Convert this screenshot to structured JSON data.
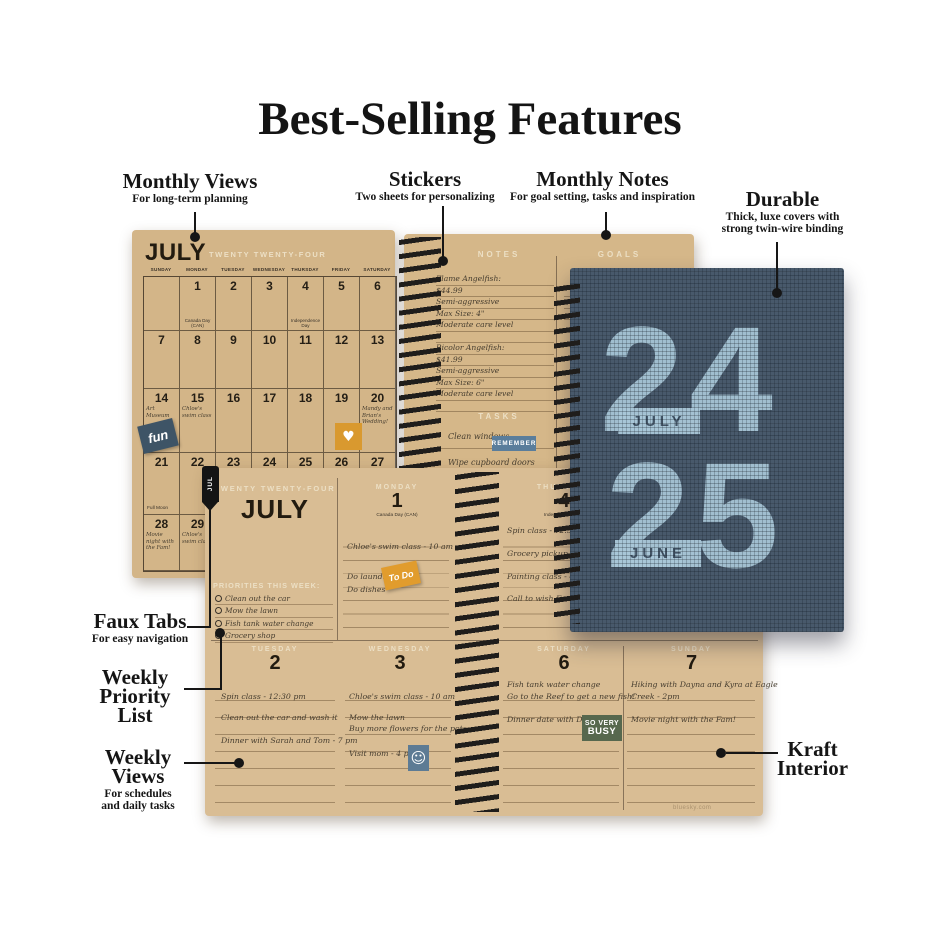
{
  "title": "Best-Selling Features",
  "callouts": {
    "monthly_views": {
      "label": "Monthly Views",
      "sub": "For long-term planning"
    },
    "stickers": {
      "label": "Stickers",
      "sub": "Two sheets for personalizing"
    },
    "monthly_notes": {
      "label": "Monthly Notes",
      "sub": "For goal setting, tasks and inspiration"
    },
    "durable": {
      "label": "Durable",
      "sub1": "Thick, luxe covers with",
      "sub2": "strong twin-wire binding"
    },
    "faux_tabs": {
      "label": "Faux Tabs",
      "sub": "For easy navigation"
    },
    "weekly_priority": {
      "line1": "Weekly",
      "line2": "Priority",
      "line3": "List"
    },
    "weekly_views": {
      "line1": "Weekly",
      "line2": "Views",
      "sub1": "For schedules",
      "sub2": "and daily tasks"
    },
    "kraft_interior": {
      "line1": "Kraft",
      "line2": "Interior"
    }
  },
  "monthly": {
    "month": "JULY",
    "year_words": "TWENTY TWENTY-FOUR",
    "day_headers": [
      "SUNDAY",
      "MONDAY",
      "TUESDAY",
      "WEDNESDAY",
      "THURSDAY",
      "FRIDAY",
      "SATURDAY"
    ],
    "weeks": [
      [
        "",
        "1",
        "2",
        "3",
        "4",
        "5",
        "6"
      ],
      [
        "7",
        "8",
        "9",
        "10",
        "11",
        "12",
        "13"
      ],
      [
        "14",
        "15",
        "16",
        "17",
        "18",
        "19",
        "20"
      ],
      [
        "21",
        "22",
        "23",
        "24",
        "25",
        "26",
        "27"
      ],
      [
        "28",
        "29",
        "30",
        "31",
        "",
        "",
        ""
      ]
    ],
    "notes": {
      "canada_day": "Canada Day (CAN)",
      "independence_day": "Independence Day",
      "art_museum": "Art Museum",
      "chloes_swim": "Chloe's swim class",
      "wedding": "Mandy and Brian's Wedding!",
      "full_moon": "Full Moon",
      "movie_night": "Movie night with the Fam!",
      "chloes_swim2": "Chloe's swim class"
    },
    "stickers": {
      "fun": "fun",
      "heart": "♥"
    }
  },
  "notes_page": {
    "notes_header": "NOTES",
    "goals_header": "GOALS",
    "tasks_header": "TASKS",
    "lines": [
      "Flame Angelfish:",
      "$44.99",
      "Semi-aggressive",
      "Max Size: 4\"",
      "Moderate care level",
      "",
      "Bicolor Angelfish:",
      "$41.99",
      "Semi-aggressive",
      "Max Size: 6\"",
      "Moderate care level",
      ""
    ],
    "tasks": [
      "Clean windows",
      "Wipe cupboard doors"
    ],
    "remember_sticker": "REMEMBER"
  },
  "weekly": {
    "tab": "JUL",
    "year_words": "TWENTY TWENTY-FOUR",
    "month": "JULY",
    "priorities_label": "PRIORITIES THIS WEEK:",
    "priorities": [
      "Clean out the car",
      "Mow the lawn",
      "Fish tank water change",
      "Grocery shop"
    ],
    "monday": {
      "name": "MONDAY",
      "num": "1",
      "holiday": "Canada Day (CAN)",
      "entries": [
        "Chloe's swim class - 10 am",
        "Do laundry",
        "Do dishes"
      ]
    },
    "thursday": {
      "name": "THURSDAY",
      "num": "4",
      "holiday": "Independence Day",
      "entries": [
        "Spin class - 12:30 pm",
        "Grocery pickup",
        "Painting class - 4 pm",
        "Call to wish Em"
      ]
    },
    "tuesday": {
      "name": "TUESDAY",
      "num": "2",
      "entries": [
        "Spin class - 12:30 pm",
        "Clean out the car and wash it",
        "Dinner with Sarah and Tom - 7 pm"
      ]
    },
    "wednesday": {
      "name": "WEDNESDAY",
      "num": "3",
      "entries": [
        "Chloe's swim class - 10 am",
        "Mow the lawn",
        "Buy more flowers for the pots",
        "Visit mom - 4 pm"
      ]
    },
    "saturday": {
      "name": "SATURDAY",
      "num": "6",
      "entries": [
        "Fish tank water change",
        "Go to the Reef to get a new fish!",
        "Dinner date with Dan"
      ]
    },
    "sunday": {
      "name": "SUNDAY",
      "num": "7",
      "entries": [
        "Hiking with Dayna and Kyra at Eagle",
        "Creek - 2pm",
        "Movie night with the Fam!"
      ]
    },
    "stickers": {
      "to_do": "To Do",
      "smiley": "☺",
      "busy_line1": "SO VERY",
      "busy_line2": "BUSY"
    },
    "footer": "bluesky.com"
  },
  "cover": {
    "top_num": "24",
    "top_month": "JULY",
    "bottom_num": "25",
    "bottom_month": "JUNE"
  },
  "colors": {
    "kraft": "#d5b789",
    "cover_navy": "#48596b",
    "cover_blue": "#a9c7d8",
    "orange": "#e19c2d",
    "slate_blue": "#5a7d9b",
    "olive_green": "#57684e",
    "tab_black": "#141414",
    "fun_navy": "#3e5466"
  }
}
